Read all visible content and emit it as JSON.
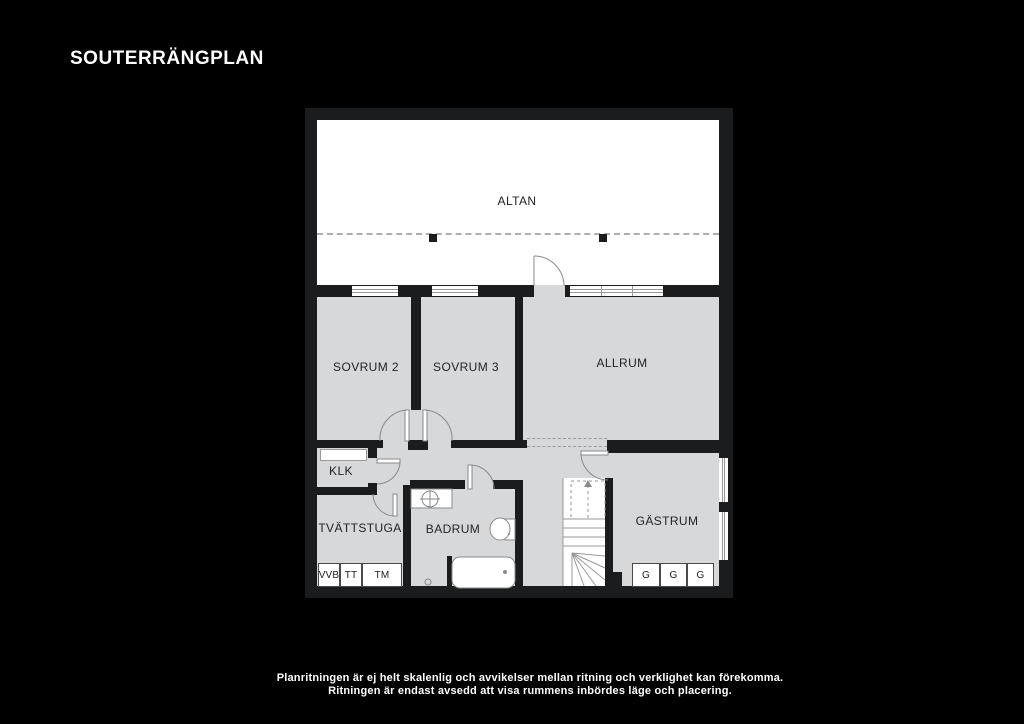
{
  "title": "SOUTERRÄNGPLAN",
  "plan": {
    "rooms": {
      "altan": {
        "label": "ALTAN"
      },
      "sovrum2": {
        "label": "SOVRUM 2"
      },
      "sovrum3": {
        "label": "SOVRUM 3"
      },
      "allrum": {
        "label": "ALLRUM"
      },
      "klk": {
        "label": "KLK"
      },
      "tvattstuga": {
        "label": "TVÄTTSTUGA"
      },
      "badrum": {
        "label": "BADRUM"
      },
      "gastrum": {
        "label": "GÄSTRUM"
      }
    },
    "appliances": [
      "VVB",
      "TT",
      "TM"
    ],
    "wardrobes": [
      "G",
      "G",
      "G"
    ]
  },
  "caption": {
    "line1": "Planritningen är ej helt skalenlig och avvikelser mellan ritning och verklighet kan förekomma.",
    "line2": "Ritningen är endast avsedd att visa rummens inbördes läge och placering."
  },
  "colors": {
    "background": "#000000",
    "wall": "#1b1c1d",
    "room_fill": "#d7d8d9",
    "altan_fill": "#ffffff",
    "line": "#8a8a8a"
  }
}
